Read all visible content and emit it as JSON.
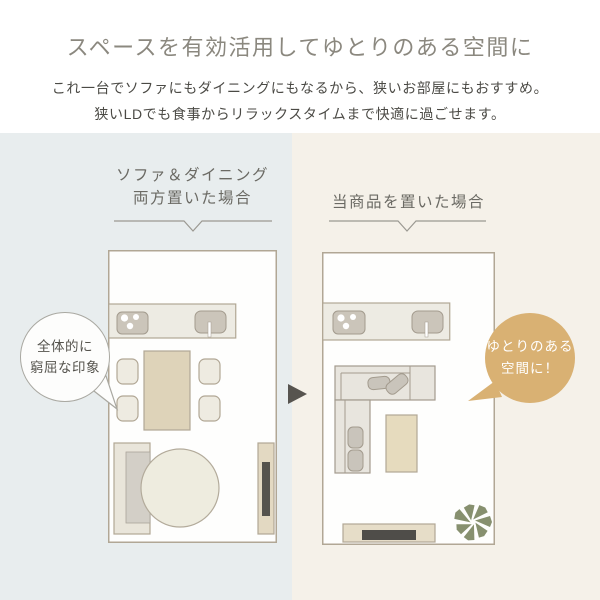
{
  "header": {
    "title": "スペースを有効活用してゆとりのある空間に",
    "subtitle_line1": "これ一台でソファにもダイニングにもなるから、狭いお部屋にもおすすめ。",
    "subtitle_line2": "狭いLDでも食事からリラックスタイムまで快適に過ごせます。"
  },
  "comparison": {
    "left": {
      "label_line1": "ソファ＆ダイニング",
      "label_line2": "両方置いた場合",
      "callout_line1": "全体的に",
      "callout_line2": "窮屈な印象"
    },
    "right": {
      "label": "当商品を置いた場合",
      "callout_line1": "ゆとりのある",
      "callout_line2": "空間に！"
    }
  },
  "colors": {
    "left_panel_bg": "#e8edee",
    "right_panel_bg": "#f5f1e9",
    "accent_gold": "#d9b173",
    "plan_outline": "#b1a795",
    "furniture_fill": "#e9e5da",
    "table_fill": "#ded3b9",
    "tv_screen": "#55534d",
    "plant_green": "#87906f",
    "arrow": "#57544f",
    "title_text": "#8b887f",
    "body_text": "#4b4a45"
  }
}
